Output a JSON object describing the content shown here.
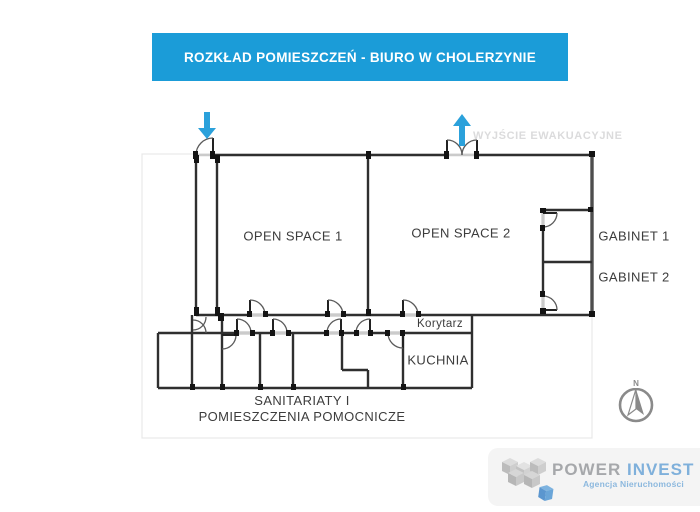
{
  "banner": {
    "title": "ROZKŁAD POMIESZCZEŃ - BIURO W CHOLERZYNIE"
  },
  "plan": {
    "exit_label": "WYJŚCIE EWAKUACYJNE",
    "rooms": {
      "open_space_1": "OPEN SPACE 1",
      "open_space_2": "OPEN SPACE 2",
      "gabinet_1": "GABINET 1",
      "gabinet_2": "GABINET 2",
      "korytarz": "Korytarz",
      "kuchnia": "KUCHNIA",
      "sanitariaty_line_1": "SANITARIATY I",
      "sanitariaty_line_2": "POMIESZCZENIA POMOCNICZE"
    },
    "compass_north": "N"
  },
  "logo": {
    "brand_word_1": "POWER",
    "brand_word_2": "INVEST",
    "tagline": "Agencja Nieruchomości"
  },
  "colors": {
    "banner_blue": "#1b9cd8",
    "arrow_blue": "#2ba1db",
    "exit_label_gray": "#dbdbdc",
    "wall_dark": "#2f2f2f",
    "room_label_gray": "#3c3c3c",
    "compass_gray": "#8a8a8a",
    "logo_gray": "#a6a8ab",
    "logo_blue": "#7fb0db"
  }
}
